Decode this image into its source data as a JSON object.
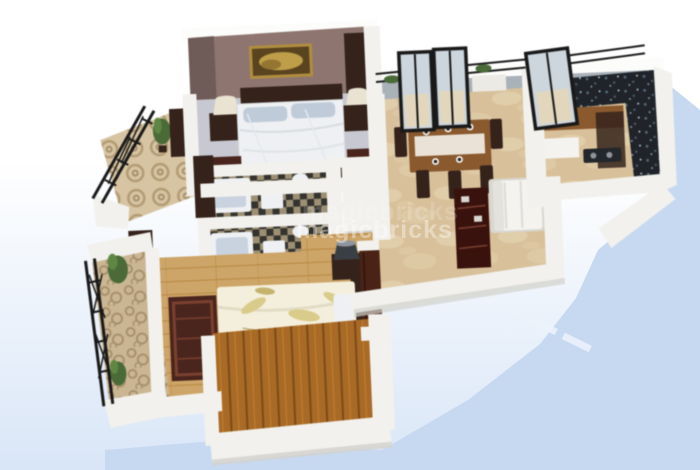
{
  "watermark": {
    "text": "magicbricks"
  },
  "scene": {
    "type": "3d-isometric-floor-plan",
    "rooms": [
      "balcony-1",
      "bedroom-2",
      "dining-room",
      "kitchen",
      "service-balcony",
      "bathroom-1",
      "bathroom-2",
      "passage",
      "living-room",
      "master-bedroom",
      "balcony-2",
      "wood-deck"
    ],
    "objects": [
      "double-bed",
      "wall-painting",
      "bedside-lamps",
      "bathtub",
      "wash-basin",
      "dining-table-six-chairs",
      "kitchen-granite-counter",
      "gas-stove",
      "tv-unit",
      "white-sofa",
      "floral-double-bed",
      "wardrobes",
      "balcony-railing",
      "potted-plants",
      "wood-deck-planks"
    ]
  },
  "palette": {
    "bg_top": "#ffffff",
    "bg_bottom": "#d9e6f7",
    "shadow": "#c7d9f0",
    "shadow_stripe": "#eef4fc",
    "wall": "#f2f1ed",
    "wall_edge": "#d2d1cc",
    "wall_bright": "#fcfcfa",
    "wall_gray_band": "#a9b1b9",
    "accent_wall": "#8e7570",
    "accent_wall_dark": "#6f5b58",
    "floor_bedroom": "#c7c8d1",
    "floor_tan": "#d8c09a",
    "floor_tan_light": "#e7d7b6",
    "checker_dark": "#34332e",
    "checker_light": "#9c8f74",
    "wood_light": "#cda568",
    "wood_mid": "#b8883f",
    "deck": "#a86a26",
    "deck_dark": "#7c4a16",
    "tile_beige": "#d6c4a2",
    "tile_ring": "#b39b74",
    "pebble": "#cbb694",
    "pebble_dark": "#a8906c",
    "granite": "#20242a",
    "granite_speck": "#55687c",
    "cabinet_wood": "#8a5a2e",
    "furniture_dark": "#35231b",
    "maroon": "#3a120d",
    "door_brown": "#4a2316",
    "rug": "#4a251d",
    "rug_border": "#7a4030",
    "bed_white": "#eef0f3",
    "pillow": "#bfcbd9",
    "duvet": "#f4efdd",
    "leaf": "#d9cc8a",
    "leaf_dark": "#c4b36e",
    "sofa": "#f4f3ef",
    "sofa_shadow": "#d9d7d1",
    "lamp_cream": "#eae3d2",
    "lamp_gray": "#8e959c",
    "plant": "#4a6b38",
    "plant_light": "#5f8743",
    "railing": "#191919",
    "window_sky": "#cdd6dd",
    "window_sand": "#e2d7bd",
    "gold": "#b08d3f",
    "art_dark": "#5a4420",
    "art_light": "#c9a84c"
  }
}
